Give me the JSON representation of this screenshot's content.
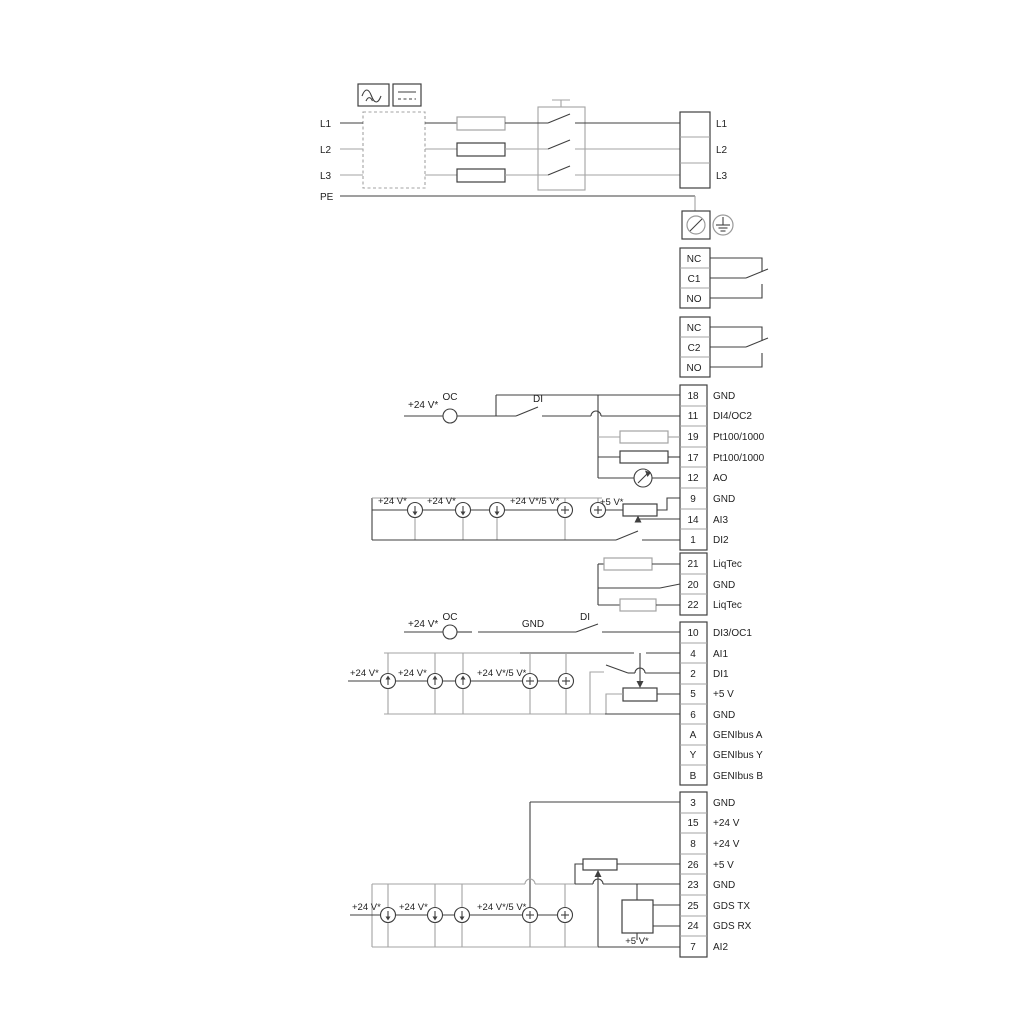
{
  "power": {
    "in": [
      "L1",
      "L2",
      "L3",
      "PE"
    ],
    "out": [
      "L1",
      "L2",
      "L3"
    ]
  },
  "relays": [
    {
      "rows": [
        "NC",
        "C1",
        "NO"
      ]
    },
    {
      "rows": [
        "NC",
        "C2",
        "NO"
      ]
    }
  ],
  "strip_a": [
    {
      "n": "18",
      "l": "GND"
    },
    {
      "n": "11",
      "l": "DI4/OC2"
    },
    {
      "n": "19",
      "l": "Pt100/1000"
    },
    {
      "n": "17",
      "l": "Pt100/1000"
    },
    {
      "n": "12",
      "l": "AO"
    },
    {
      "n": "9",
      "l": "GND"
    },
    {
      "n": "14",
      "l": "AI3"
    },
    {
      "n": "1",
      "l": "DI2"
    }
  ],
  "strip_b": [
    {
      "n": "21",
      "l": "LiqTec"
    },
    {
      "n": "20",
      "l": "GND"
    },
    {
      "n": "22",
      "l": "LiqTec"
    }
  ],
  "strip_c": [
    {
      "n": "10",
      "l": "DI3/OC1"
    },
    {
      "n": "4",
      "l": "AI1"
    },
    {
      "n": "2",
      "l": "DI1"
    },
    {
      "n": "5",
      "l": "+5 V"
    },
    {
      "n": "6",
      "l": "GND"
    },
    {
      "n": "A",
      "l": "GENIbus A"
    },
    {
      "n": "Y",
      "l": "GENIbus Y"
    },
    {
      "n": "B",
      "l": "GENIbus B"
    }
  ],
  "strip_d": [
    {
      "n": "3",
      "l": "GND"
    },
    {
      "n": "15",
      "l": "+24 V"
    },
    {
      "n": "8",
      "l": "+24 V"
    },
    {
      "n": "26",
      "l": "+5 V"
    },
    {
      "n": "23",
      "l": "GND"
    },
    {
      "n": "25",
      "l": "GDS TX"
    },
    {
      "n": "24",
      "l": "GDS RX"
    },
    {
      "n": "7",
      "l": "AI2"
    }
  ],
  "labels": {
    "oc": "OC",
    "di": "DI",
    "gnd": "GND",
    "v24": "+24 V*",
    "v24v5": "+24 V*/5 V*",
    "v5": "+5 V*"
  },
  "colors": {
    "wire": "#3f3f3f",
    "wire_gray": "#a3a3a3",
    "text": "#1f1f1f"
  }
}
